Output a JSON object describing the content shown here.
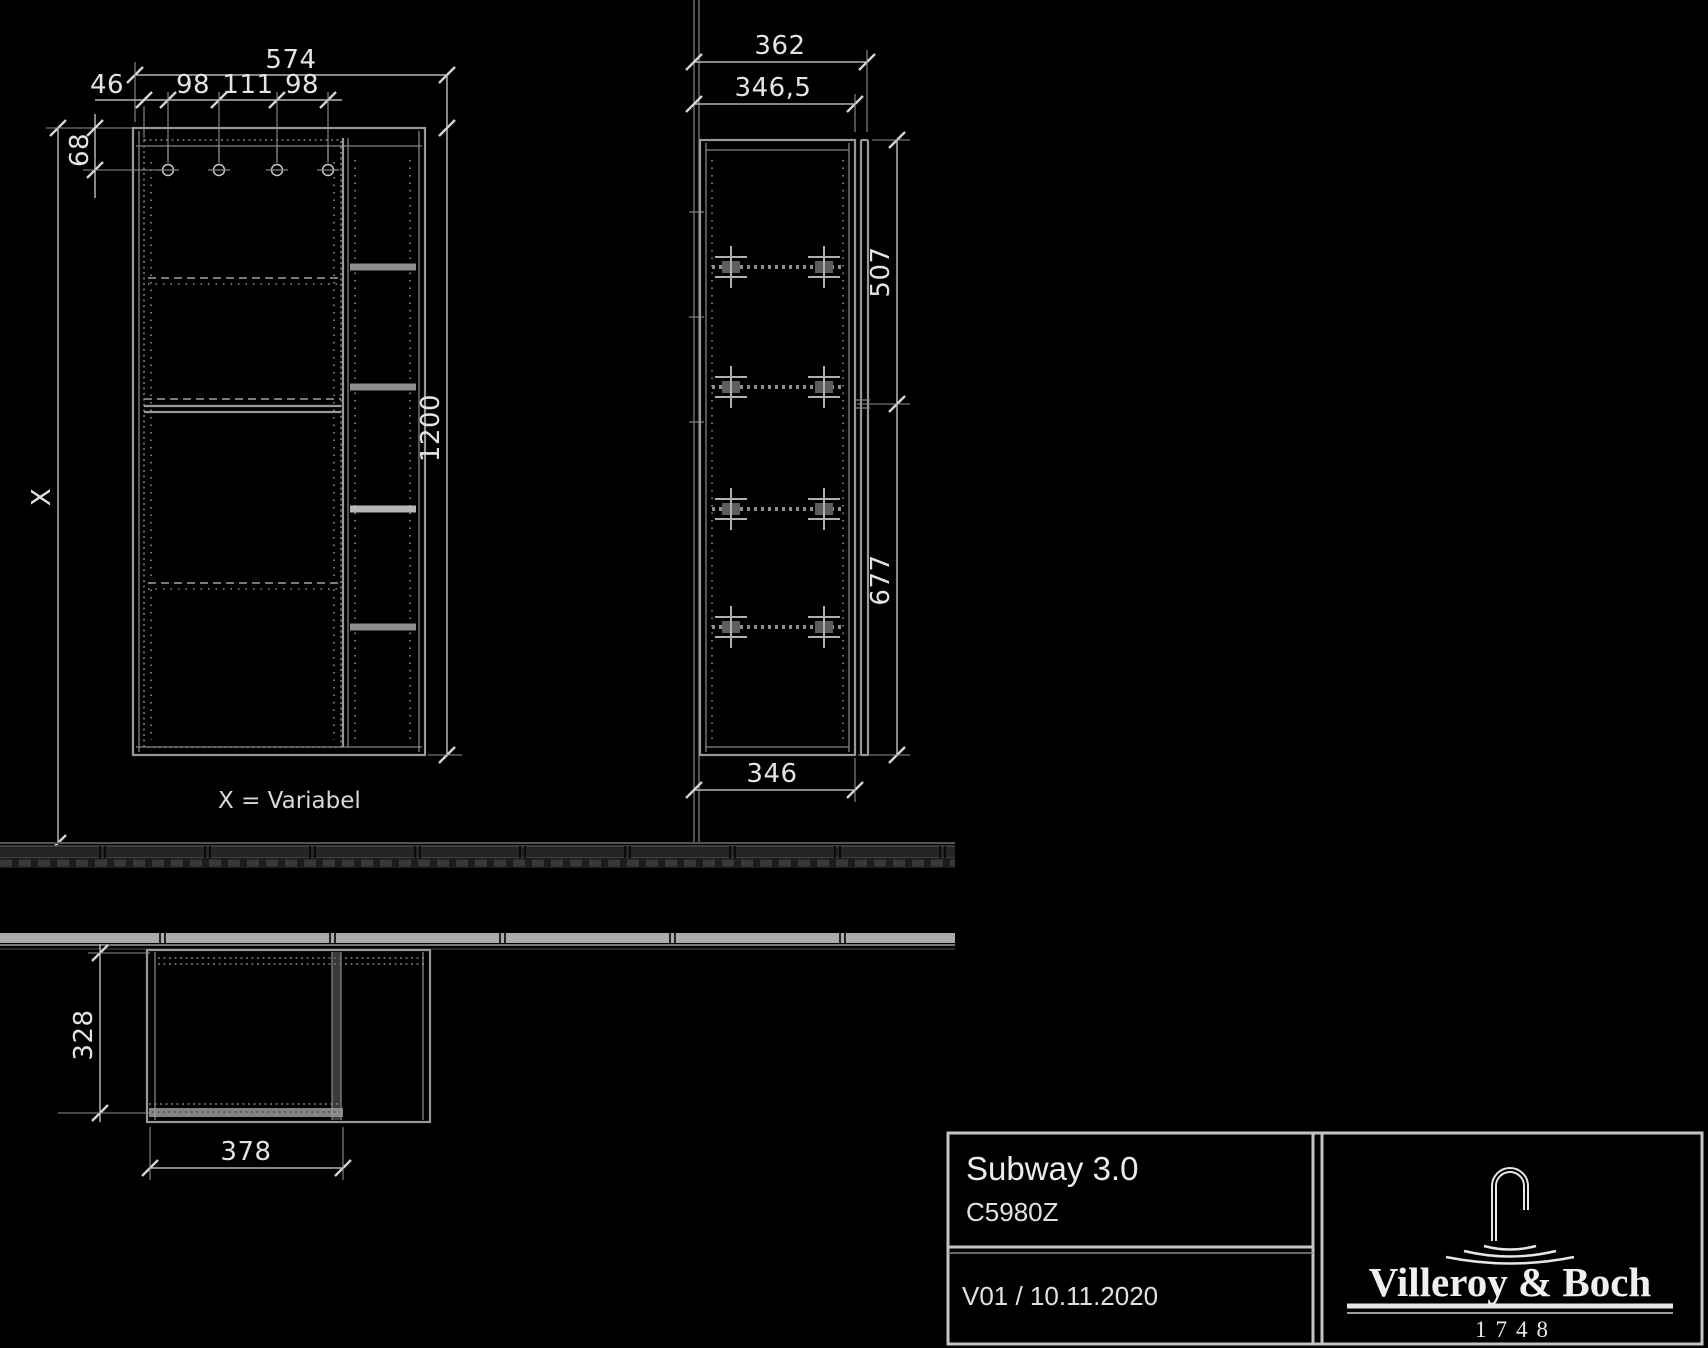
{
  "drawing": {
    "views": {
      "front": {
        "dims": {
          "total_width": "574",
          "hinge_offset_left": "46",
          "hinge_spacing_1": "98",
          "hinge_spacing_2": "111",
          "hinge_spacing_3": "98",
          "top_to_hinge": "68",
          "height": "1200",
          "mounting_height": "X"
        },
        "note": "X = Variabel"
      },
      "side": {
        "dims": {
          "total_depth": "362",
          "depth_without_front": "346,5",
          "upper_door_height": "507",
          "lower_door_height": "677",
          "carcass_depth": "346"
        }
      },
      "plan": {
        "dims": {
          "depth": "328",
          "door_width": "378"
        }
      }
    },
    "title_block": {
      "series": "Subway 3.0",
      "article_number": "C5980Z",
      "version_date": "V01 / 10.11.2020",
      "brand": "Villeroy & Boch",
      "brand_year": "1748"
    },
    "colors": {
      "background": "#000000",
      "outline": "#989898",
      "dim_line": "#b4b4b4",
      "text": "#e3e3e3",
      "title_border": "#c4c4c4"
    }
  }
}
